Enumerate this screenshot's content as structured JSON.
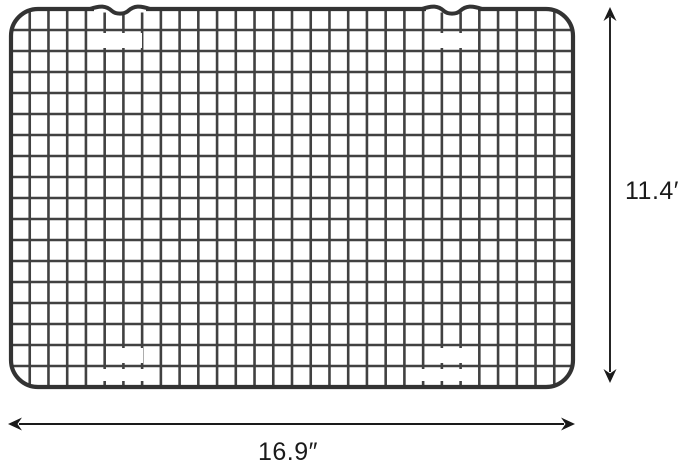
{
  "page": {
    "background": "#ffffff",
    "description": "Wire cooling rack product image with dimension annotations"
  },
  "product_image": {
    "name": "wire-cooling-rack-grid",
    "wire_color": "#414141",
    "frame_color": "#333333",
    "background": "#ffffff"
  },
  "dimensions": {
    "annotation_color": "#1a1a1a",
    "height_label": "11.4″",
    "width_label": "16.9″"
  }
}
